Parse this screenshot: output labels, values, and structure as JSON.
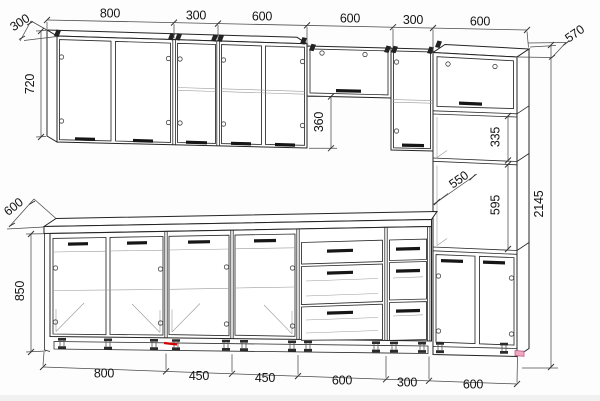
{
  "drawing": {
    "kind": "kitchen cabinet elevation, wireframe technical drawing",
    "units": "mm"
  },
  "dims": {
    "top_chain": [
      "800",
      "300",
      "600",
      "600",
      "300",
      "600"
    ],
    "bottom_chain": [
      "800",
      "450",
      "450",
      "600",
      "300",
      "600"
    ],
    "wall_depth": "300",
    "wall_height": "720",
    "hood_gap": "360",
    "base_depth": "600",
    "base_height": "850",
    "tall_depth": "570",
    "shelf_section": "335",
    "interior_depth": "550",
    "niche_height": "595",
    "total_height": "2145"
  }
}
